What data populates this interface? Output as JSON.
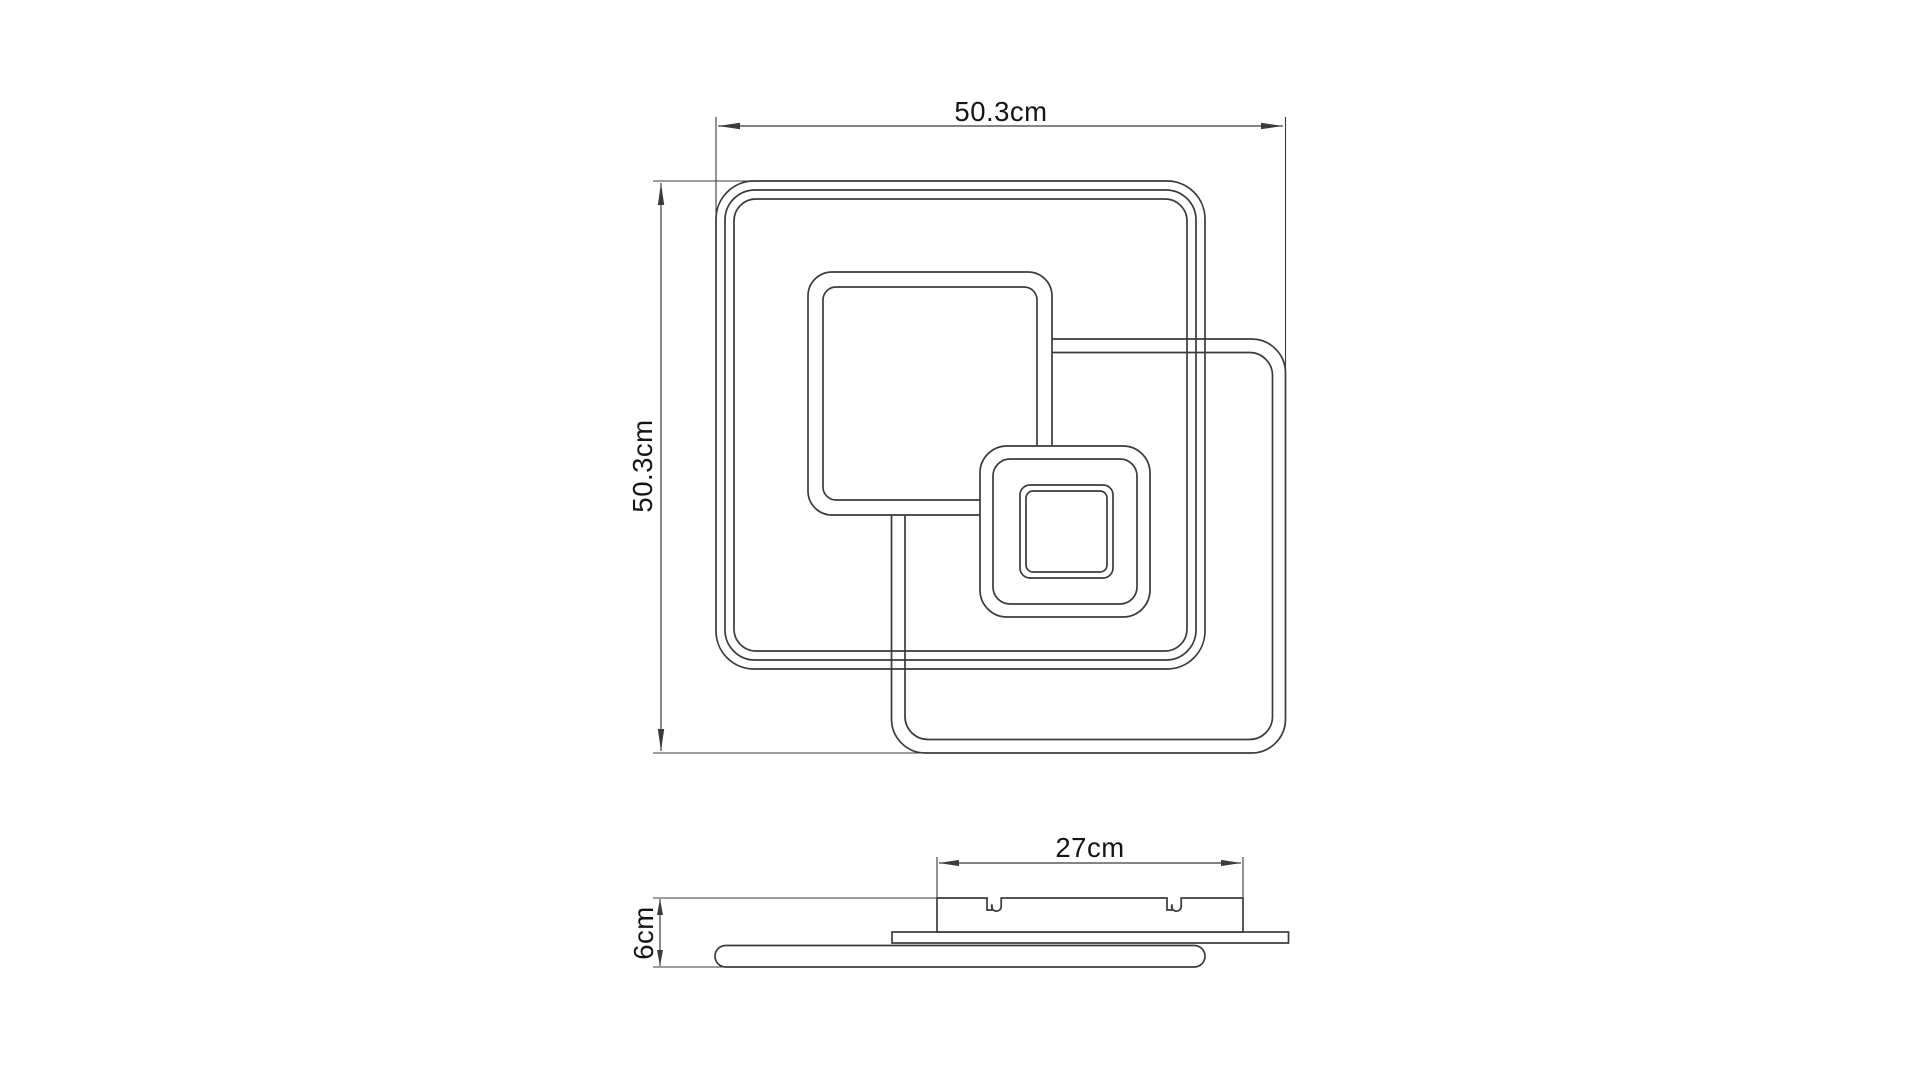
{
  "dims": {
    "top_view": {
      "width": "50.3cm",
      "height": "50.3cm"
    },
    "side_view": {
      "width": "27cm",
      "height": "6cm"
    }
  },
  "colors": {
    "background": "#ffffff",
    "line": "#3b3b3b",
    "text": "#151515"
  }
}
